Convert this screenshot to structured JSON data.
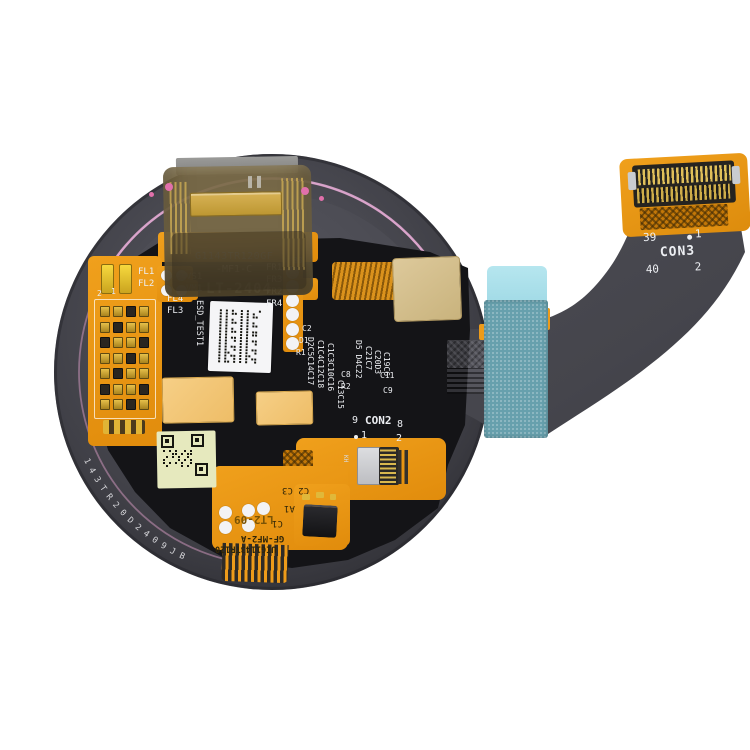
{
  "product": {
    "description": "Smartwatch round LCD display with flex cable assembly, rear view"
  },
  "colors": {
    "background": "#FFFFFF",
    "flex_orange": "#ED9B1A",
    "pcb_black": "#141417",
    "disc_gray": "#46464C",
    "teal_patch": "#68A1AE",
    "teal_patch_light": "#ABE0EA",
    "pink_ring": "#DD9FCC",
    "gold_pad": "#D6C293",
    "tan_pad": "#F3C87D",
    "silkscreen_white": "#ECEEF2"
  },
  "silkscreen": {
    "part_number": "G1143TR120GF",
    "part_suffix": "-MF1-C",
    "date_stamp": "LT-2404",
    "esd_test": "ESD_TEST1",
    "ref_83": "83",
    "vs1": "VS1",
    "vm1": "VM1",
    "fl1": "FL1",
    "fl2": "FL2",
    "fl4": "FL4",
    "fl3": "FL3",
    "fr1": "FR1",
    "fr3": "FR3",
    "fr2": "FR2",
    "fr4": "FR4",
    "pad_2": "2",
    "pad_1": "1",
    "c2": "C2",
    "d1": "D1",
    "r1": "R1",
    "c8": "C8",
    "r2": "R2",
    "c11": "C11",
    "c9": "C9",
    "cols_a": [
      "D2C5C14C17",
      "C1C4C12C18",
      "C1C3C10C16",
      "C13C15"
    ],
    "cols_b": [
      "D5 D4C22",
      "C21C7",
      "C20D3",
      "C19C6"
    ]
  },
  "con2": {
    "label": "CON2",
    "pin_9": "9",
    "pin_8": "8",
    "pin_1": "1",
    "pin_2": "2",
    "kh": "KH"
  },
  "con3": {
    "label": "CON3",
    "pin_39": "39",
    "pin_1": "1",
    "pin_40": "40",
    "pin_2": "2"
  },
  "bottom_flex": {
    "c2_c3": "C2 C3",
    "a1": "A1",
    "c1": "C1",
    "stamp": "LT2-09",
    "gf_code": "GF-MF2-A",
    "uig_code": "UIG1143TR120"
  },
  "rim_serial": "143TR20D2409JB"
}
